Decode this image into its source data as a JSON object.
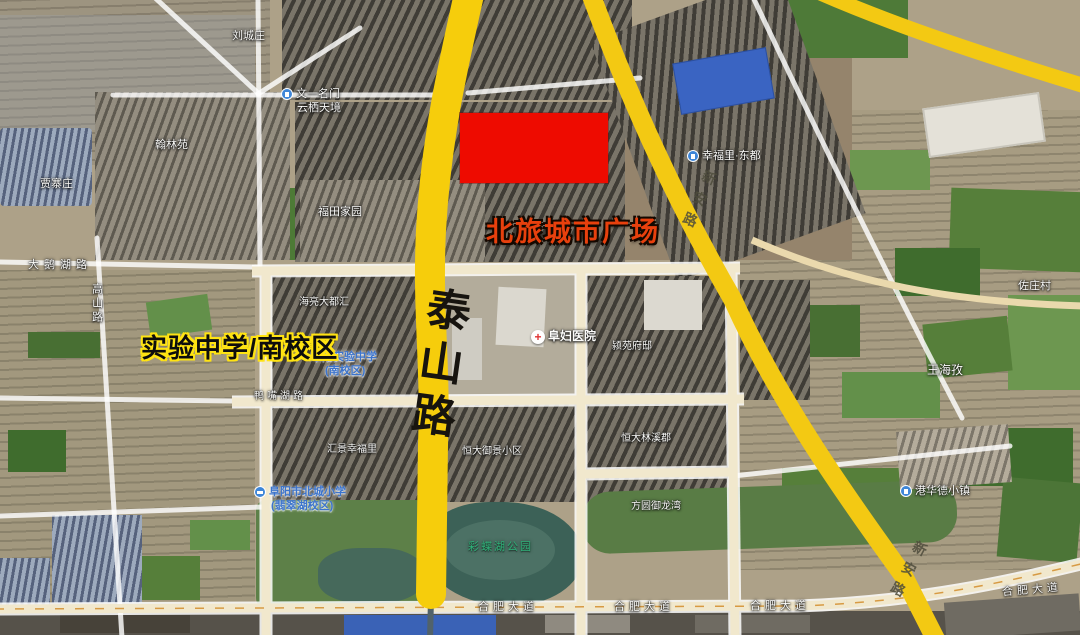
{
  "annotations": {
    "plaza_label": "北旅城市广场",
    "school_label": "实验中学/南校区",
    "highlight_color": "#ee0b00",
    "highlight_label_color": "#e8400d",
    "school_outline_color": "#ffe312",
    "road_highlight_color": "#f6cd0c"
  },
  "roads": {
    "taishan": "泰山路",
    "xinan": "新安路",
    "hefei_avenue": "合肥大道",
    "daehu": "大鹅湖路",
    "gaoshan": "高山路",
    "yazuihu": "鸭嘴湖路"
  },
  "pois": [
    {
      "text": "刘城庄"
    },
    {
      "text": "翰林苑"
    },
    {
      "text": "贾寨庄"
    },
    {
      "text": "福田家园"
    },
    {
      "text": "文一名门"
    },
    {
      "text": "云栖天境"
    },
    {
      "text": "幸福里·东都"
    },
    {
      "text": "海亮大都汇"
    },
    {
      "text": "阜阳实验中学"
    },
    {
      "text": "(南校区)"
    },
    {
      "text": "阜妇医院"
    },
    {
      "text": "颍苑府邸"
    },
    {
      "text": "恒大御景小区"
    },
    {
      "text": "恒大林溪郡"
    },
    {
      "text": "汇景幸福里"
    },
    {
      "text": "阜阳市北城小学"
    },
    {
      "text": "(翡翠湖校区)"
    },
    {
      "text": "方圆御龙湾"
    },
    {
      "text": "彩蝶湖公园"
    },
    {
      "text": "港华德小镇"
    },
    {
      "text": "佐庄村"
    },
    {
      "text": "王海孜"
    }
  ]
}
